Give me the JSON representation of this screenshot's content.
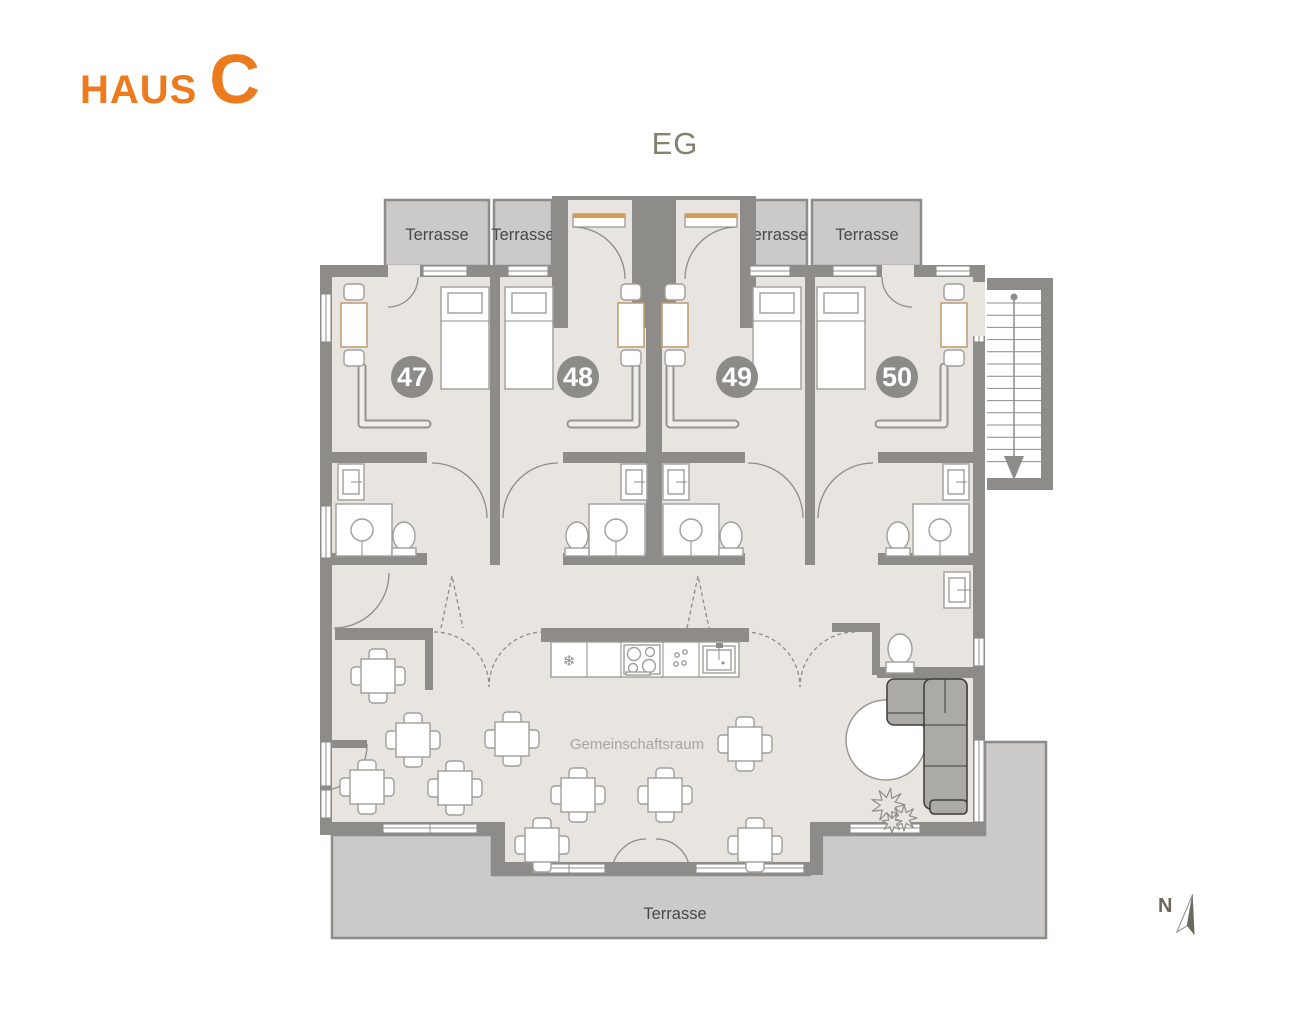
{
  "header": {
    "haus": "HAUS",
    "letter": "C"
  },
  "floor_label": "EG",
  "terraces": {
    "top": [
      "Terrasse",
      "Terrasse",
      "Terrasse",
      "Terrasse"
    ],
    "bottom": "Terrasse"
  },
  "rooms": [
    {
      "number": "47"
    },
    {
      "number": "48"
    },
    {
      "number": "49"
    },
    {
      "number": "50"
    }
  ],
  "common_room": {
    "label": "Gemeinschaftsraum"
  },
  "kitchen": {
    "snowflake_icon": "❄"
  },
  "compass": {
    "label": "N"
  },
  "colors": {
    "accent": "#ED7A1C",
    "wall": "#8E8C89",
    "floor": "#E8E5E1",
    "terrace": "#CBCAC8",
    "badge": "#8D8B88",
    "muted": "#85816F"
  }
}
